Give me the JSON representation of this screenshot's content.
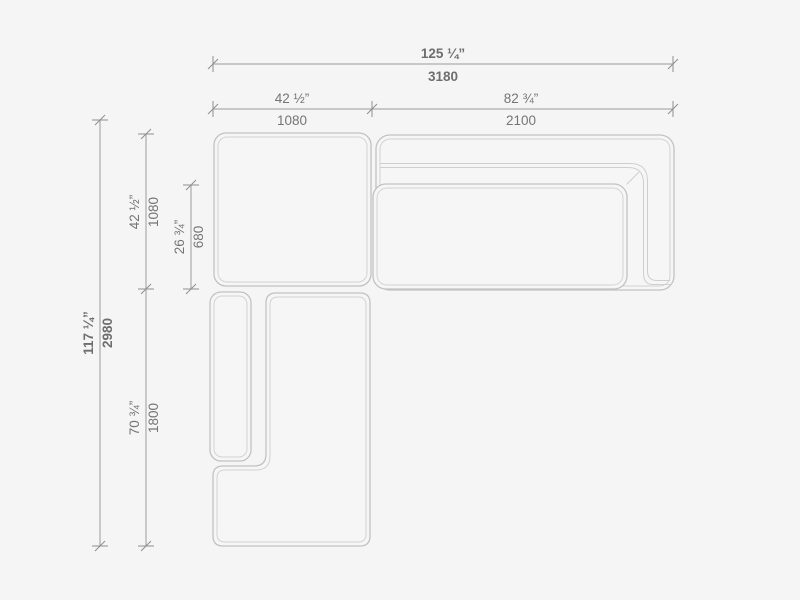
{
  "drawing": {
    "type": "sectional-sofa-top-view-dimensional-drawing",
    "dimensions": {
      "overall_width": {
        "inches": "125 ¼”",
        "mm": "3180"
      },
      "left_section_width": {
        "inches": "42 ½”",
        "mm": "1080"
      },
      "right_section_width": {
        "inches": "82 ¾”",
        "mm": "2100"
      },
      "overall_depth": {
        "inches": "117 ¼”",
        "mm": "2980"
      },
      "top_section_depth": {
        "inches": "42 ½”",
        "mm": "1080"
      },
      "seat_cushion_depth": {
        "inches": "26 ¾”",
        "mm": "680"
      },
      "bottom_section_depth": {
        "inches": "70 ¾”",
        "mm": "1800"
      }
    },
    "colors": {
      "background": "#f5f5f5",
      "outline_outer": "#c2c2c2",
      "outline_inner": "#d3d3d3",
      "dimension_line": "#9a9a9a",
      "dimension_text": "#757575"
    }
  }
}
